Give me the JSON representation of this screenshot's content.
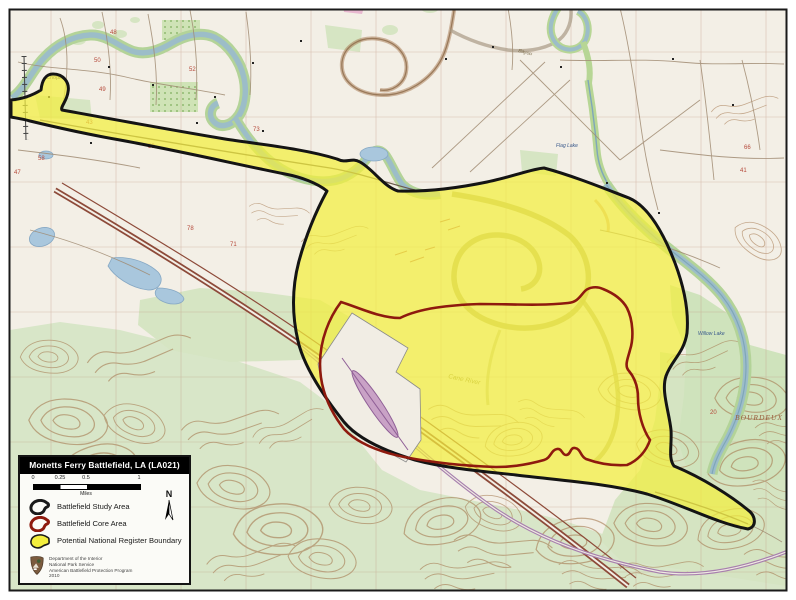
{
  "map": {
    "frame_color": "#1a1a1a",
    "paper_color": "#f3efe6",
    "labels": {
      "chopin": "Chopin",
      "flag_lake": "Flag Lake",
      "willow_lake": "Willow Lake",
      "bourdeux": "BOURDEUX",
      "cane_river": "Cane River",
      "bayou": "Bayou"
    },
    "section_numbers": [
      "48",
      "50",
      "49",
      "43",
      "52",
      "53",
      "58",
      "47",
      "73",
      "71",
      "78",
      "66",
      "41",
      "20"
    ]
  },
  "legend": {
    "title": "Monetts Ferry Battlefield, LA (LA021)",
    "scale_bar": {
      "ticks": [
        "0",
        "0.25",
        "0.5",
        "1"
      ],
      "unit_label": "Miles"
    },
    "north_label": "N",
    "items": [
      {
        "id": "study-area",
        "label": "Battlefield Study Area",
        "swatch_color": "#1a1a1a"
      },
      {
        "id": "core-area",
        "label": "Battlefield Core Area",
        "swatch_color": "#8e1a0e"
      },
      {
        "id": "register-boundary",
        "label": "Potential National Register Boundary",
        "swatch_color": "#f3ee3e"
      }
    ],
    "credit_lines": [
      "Department of the Interior",
      "National Park Service",
      "American Battlefield Protection Program",
      "2010"
    ]
  },
  "overlay_colors": {
    "study_area_outline": "#141414",
    "core_area_line": "#8e1a0e",
    "register_boundary_fill": "#f3ee3e",
    "excluded_parcel_fill": "#f1ede4",
    "highway": "#8d4a39",
    "water": "#9cbdc8",
    "vegetation": "#d3e3bb",
    "contours": "#a5784f"
  }
}
